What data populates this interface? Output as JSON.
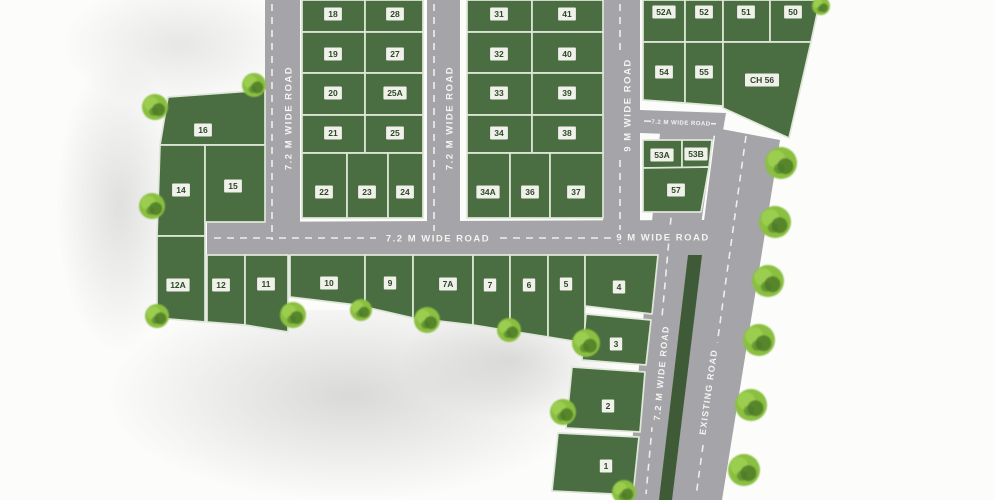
{
  "map_title": "Residential plot layout site plan",
  "colors": {
    "plot_green": "#4a6e41",
    "plot_stroke": "#dfe7d8",
    "road_gray": "#a4a4a9",
    "median_green": "#3e5a36",
    "dash_white": "#f2f2ee",
    "plot_label_bg": "#f7f7f2",
    "plot_label_text": "#2c4926",
    "tree_light": "#8abf3f",
    "tree_mid": "#9ccf52",
    "tree_dark": "#4c7a28"
  },
  "roads": {
    "v1_label": "7.2 M WIDE ROAD",
    "v2_label": "7.2 M WIDE ROAD",
    "v3_label": "9 M WIDE ROAD",
    "h1_label_72": "7.2 M WIDE ROAD",
    "h1_label_9": "9 M WIDE ROAD",
    "h2_label": "7.2 M WIDE ROAD",
    "v4_label": "7.2 M WIDE ROAD",
    "existing_label": "EXISTING ROAD"
  },
  "plots": [
    {
      "label": "18",
      "points": "302,0 365,0 365,32 302,32",
      "lx": 333,
      "ly": 14
    },
    {
      "label": "28",
      "points": "365,0 423,0 423,32 365,32",
      "lx": 395,
      "ly": 14
    },
    {
      "label": "19",
      "points": "302,32 365,32 365,73 302,73",
      "lx": 333,
      "ly": 54
    },
    {
      "label": "27",
      "points": "365,32 423,32 423,73 365,73",
      "lx": 395,
      "ly": 54
    },
    {
      "label": "20",
      "points": "302,73 365,73 365,115 302,115",
      "lx": 333,
      "ly": 93
    },
    {
      "label": "25A",
      "points": "365,73 423,73 423,115 365,115",
      "lx": 395,
      "ly": 93
    },
    {
      "label": "21",
      "points": "302,115 365,115 365,153 302,153",
      "lx": 333,
      "ly": 133
    },
    {
      "label": "25",
      "points": "365,115 423,115 423,153 365,153",
      "lx": 395,
      "ly": 133
    },
    {
      "label": "22",
      "points": "302,153 347,153 347,218 302,218",
      "lx": 324,
      "ly": 192
    },
    {
      "label": "23",
      "points": "347,153 388,153 388,218 347,218",
      "lx": 367,
      "ly": 192
    },
    {
      "label": "24",
      "points": "388,153 423,153 423,218 388,218",
      "lx": 405,
      "ly": 192
    },
    {
      "label": "31",
      "points": "467,0 532,0 532,32 467,32",
      "lx": 499,
      "ly": 14
    },
    {
      "label": "41",
      "points": "532,0 603,0 603,32 532,32",
      "lx": 567,
      "ly": 14
    },
    {
      "label": "32",
      "points": "467,32 532,32 532,73 467,73",
      "lx": 499,
      "ly": 54
    },
    {
      "label": "40",
      "points": "532,32 603,32 603,73 532,73",
      "lx": 567,
      "ly": 54
    },
    {
      "label": "33",
      "points": "467,73 532,73 532,115 467,115",
      "lx": 499,
      "ly": 93
    },
    {
      "label": "39",
      "points": "532,73 603,73 603,115 532,115",
      "lx": 567,
      "ly": 93
    },
    {
      "label": "34",
      "points": "467,115 532,115 532,153 467,153",
      "lx": 499,
      "ly": 133
    },
    {
      "label": "38",
      "points": "532,115 603,115 603,153 532,153",
      "lx": 567,
      "ly": 133
    },
    {
      "label": "34A",
      "points": "467,153 510,153 510,218 467,218",
      "lx": 488,
      "ly": 192
    },
    {
      "label": "36",
      "points": "510,153 550,153 550,218 510,218",
      "lx": 530,
      "ly": 192
    },
    {
      "label": "37",
      "points": "550,153 603,153 603,218 550,218",
      "lx": 576,
      "ly": 192
    },
    {
      "label": "52A",
      "points": "643,0 685,0 685,42 643,42",
      "lx": 664,
      "ly": 12
    },
    {
      "label": "52",
      "points": "685,0 723,0 723,42 685,42",
      "lx": 704,
      "ly": 12
    },
    {
      "label": "51",
      "points": "723,0 770,0 770,42 723,42",
      "lx": 746,
      "ly": 12
    },
    {
      "label": "50",
      "points": "770,0 820,0 811,42 770,42",
      "lx": 793,
      "ly": 12
    },
    {
      "label": "54",
      "points": "643,42 685,42 685,103 643,100",
      "lx": 664,
      "ly": 72
    },
    {
      "label": "55",
      "points": "685,42 723,42 723,106 685,103",
      "lx": 704,
      "ly": 72
    },
    {
      "label": "CH 56",
      "points": "723,42 811,42 789,138 723,108",
      "lx": 762,
      "ly": 80
    },
    {
      "label": "53A",
      "points": "643,140 682,140 682,168 643,168",
      "lx": 662,
      "ly": 155
    },
    {
      "label": "53B",
      "points": "682,140 712,140 709,167 682,168",
      "lx": 696,
      "ly": 154
    },
    {
      "label": "57",
      "points": "643,168 709,167 701,212 643,212",
      "lx": 676,
      "ly": 190
    },
    {
      "label": "16",
      "points": "168,97 265,90 265,145 160,145",
      "lx": 203,
      "ly": 130
    },
    {
      "label": "14",
      "points": "160,145 205,145 205,236 157,236",
      "lx": 181,
      "ly": 190
    },
    {
      "label": "15",
      "points": "205,145 265,145 265,222 205,222",
      "lx": 233,
      "ly": 186
    },
    {
      "label": "12A",
      "points": "157,236 205,236 205,322 157,318",
      "lx": 178,
      "ly": 285
    },
    {
      "label": "12",
      "points": "207,255 245,255 245,325 207,322",
      "lx": 221,
      "ly": 285
    },
    {
      "label": "11",
      "points": "245,255 288,255 288,332 245,325",
      "lx": 266,
      "ly": 284
    },
    {
      "label": "10",
      "points": "290,255 365,255 365,306 290,297",
      "lx": 329,
      "ly": 283
    },
    {
      "label": "9",
      "points": "365,255 413,255 413,318 365,307",
      "lx": 390,
      "ly": 283
    },
    {
      "label": "7A",
      "points": "413,255 473,255 473,325 413,318",
      "lx": 448,
      "ly": 284
    },
    {
      "label": "7",
      "points": "473,255 510,255 510,331 473,325",
      "lx": 490,
      "ly": 285
    },
    {
      "label": "6",
      "points": "510,255 548,255 548,337 510,331",
      "lx": 529,
      "ly": 285
    },
    {
      "label": "5",
      "points": "548,255 585,255 585,343 548,337",
      "lx": 566,
      "ly": 284
    },
    {
      "label": "4",
      "points": "585,255 658,255 652,314 585,306",
      "lx": 619,
      "ly": 287
    },
    {
      "label": "3",
      "points": "586,314 651,320 646,365 582,360",
      "lx": 616,
      "ly": 344
    },
    {
      "label": "2",
      "points": "572,367 645,372 640,432 566,428",
      "lx": 608,
      "ly": 406
    },
    {
      "label": "1",
      "points": "558,433 639,437 633,495 552,491",
      "lx": 606,
      "ly": 466
    }
  ],
  "trees": [
    [
      155,
      107,
      13
    ],
    [
      254,
      85,
      12
    ],
    [
      152,
      206,
      13
    ],
    [
      157,
      316,
      12
    ],
    [
      293,
      315,
      13
    ],
    [
      361,
      310,
      11
    ],
    [
      427,
      320,
      13
    ],
    [
      509,
      330,
      12
    ],
    [
      586,
      343,
      14
    ],
    [
      563,
      412,
      13
    ],
    [
      624,
      492,
      12
    ],
    [
      821,
      6,
      9
    ],
    [
      781,
      163,
      16
    ],
    [
      775,
      222,
      16
    ],
    [
      768,
      281,
      16
    ],
    [
      759,
      340,
      16
    ],
    [
      751,
      405,
      16
    ],
    [
      744,
      470,
      16
    ]
  ]
}
